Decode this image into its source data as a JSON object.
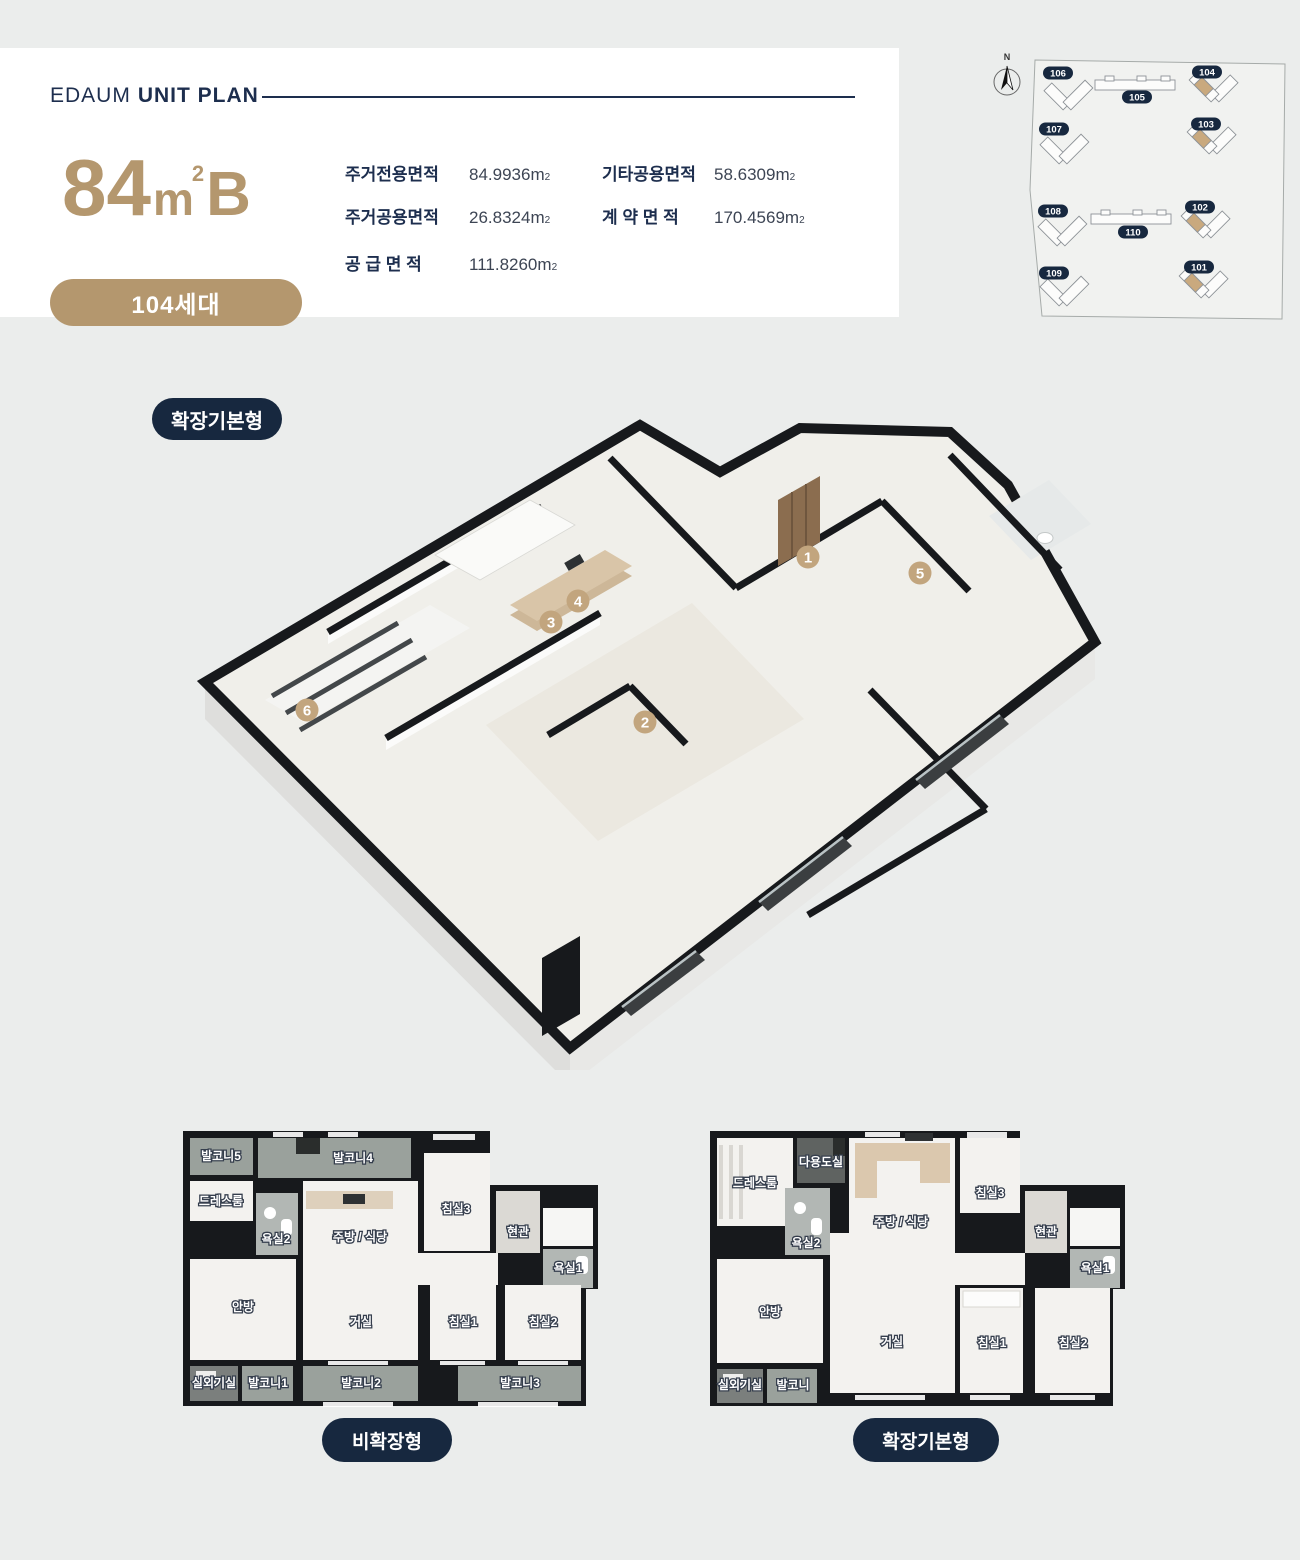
{
  "page": {
    "background": "#ebedec"
  },
  "colors": {
    "navy": "#1d2e4e",
    "tan": "#b4976e",
    "marker_tan": "#c2a57e",
    "pill_navy": "#17283f",
    "wall_black": "#17191c",
    "balcony_floor": "#9aa19c",
    "bath_floor": "#b2b7b4",
    "room_floor": "#f3f2ef"
  },
  "header": {
    "brand": "EDAUM",
    "title": "UNIT PLAN",
    "unit": {
      "number": "84",
      "unit_base": "m",
      "unit_sup": "2",
      "letter": "B"
    },
    "households_badge": "104세대",
    "areas": {
      "unit_base": "m",
      "unit_sup": "2",
      "col1": [
        {
          "label": "주거전용면적",
          "value": "84.9936"
        },
        {
          "label": "주거공용면적",
          "value": "26.8324"
        },
        {
          "label": "공 급 면 적",
          "value": "111.8260"
        }
      ],
      "col2": [
        {
          "label": "기타공용면적",
          "value": "58.6309"
        },
        {
          "label": "계 약 면 적",
          "value": "170.4569"
        }
      ]
    }
  },
  "site_plan": {
    "compass_label": "N",
    "buildings": [
      {
        "id": "106",
        "highlighted": false
      },
      {
        "id": "105",
        "highlighted": false
      },
      {
        "id": "104",
        "highlighted": true
      },
      {
        "id": "107",
        "highlighted": false
      },
      {
        "id": "103",
        "highlighted": true
      },
      {
        "id": "108",
        "highlighted": false
      },
      {
        "id": "110",
        "highlighted": false
      },
      {
        "id": "102",
        "highlighted": true
      },
      {
        "id": "109",
        "highlighted": false
      },
      {
        "id": "101",
        "highlighted": true
      }
    ]
  },
  "iso_plan": {
    "type_badge": "확장기본형",
    "markers": [
      "1",
      "2",
      "3",
      "4",
      "5",
      "6"
    ]
  },
  "floor_plans": [
    {
      "badge": "비확장형",
      "rooms": [
        "발코니5",
        "발코니4",
        "드레스룸",
        "욕실2",
        "주방 / 식당",
        "침실3",
        "현관",
        "욕실1",
        "안방",
        "거실",
        "침실1",
        "침실2",
        "실외기실",
        "발코니1",
        "발코니2",
        "발코니3"
      ]
    },
    {
      "badge": "확장기본형",
      "rooms": [
        "드레스룸",
        "다용도실",
        "주방 / 식당",
        "침실3",
        "현관",
        "욕실2",
        "욕실1",
        "안방",
        "거실",
        "침실1",
        "침실2",
        "실외기실",
        "발코니"
      ]
    }
  ]
}
